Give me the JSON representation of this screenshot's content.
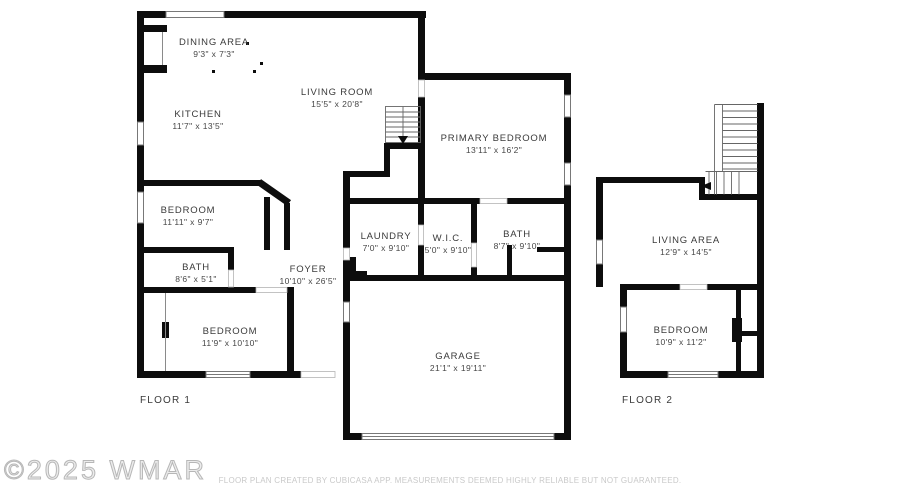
{
  "floor1": {
    "label": "FLOOR 1",
    "rooms": {
      "dining": {
        "name": "DINING AREA",
        "dims": "9'3\" x 7'3\""
      },
      "living": {
        "name": "LIVING ROOM",
        "dims": "15'5\" x 20'8\""
      },
      "kitchen": {
        "name": "KITCHEN",
        "dims": "11'7\" x 13'5\""
      },
      "primary_bedroom": {
        "name": "PRIMARY BEDROOM",
        "dims": "13'11\" x 16'2\""
      },
      "bedroom_mid": {
        "name": "BEDROOM",
        "dims": "11'11\" x 9'7\""
      },
      "bath_small": {
        "name": "BATH",
        "dims": "8'6\" x 5'1\""
      },
      "foyer": {
        "name": "FOYER",
        "dims": "10'10\" x 26'5\""
      },
      "laundry": {
        "name": "LAUNDRY",
        "dims": "7'0\" x 9'10\""
      },
      "wic": {
        "name": "W.I.C.",
        "dims": "5'0\" x 9'10\""
      },
      "bath_primary": {
        "name": "BATH",
        "dims": "8'7\" x 9'10\""
      },
      "bedroom_lower": {
        "name": "BEDROOM",
        "dims": "11'9\" x 10'10\""
      },
      "garage": {
        "name": "GARAGE",
        "dims": "21'1\" x 19'11\""
      }
    }
  },
  "floor2": {
    "label": "FLOOR 2",
    "rooms": {
      "living_area": {
        "name": "LIVING AREA",
        "dims": "12'9\" x 14'5\""
      },
      "bedroom": {
        "name": "BEDROOM",
        "dims": "10'9\" x 11'2\""
      }
    }
  },
  "footer": {
    "copyright": "©2025 WMAR",
    "disclaimer": "FLOOR PLAN CREATED BY CUBICASA APP. MEASUREMENTS DEEMED HIGHLY RELIABLE BUT NOT GUARANTEED."
  },
  "colors": {
    "wall": "#0d0d0d",
    "label_text": "#3a3a3a",
    "footer_text": "#c9c9c9"
  }
}
